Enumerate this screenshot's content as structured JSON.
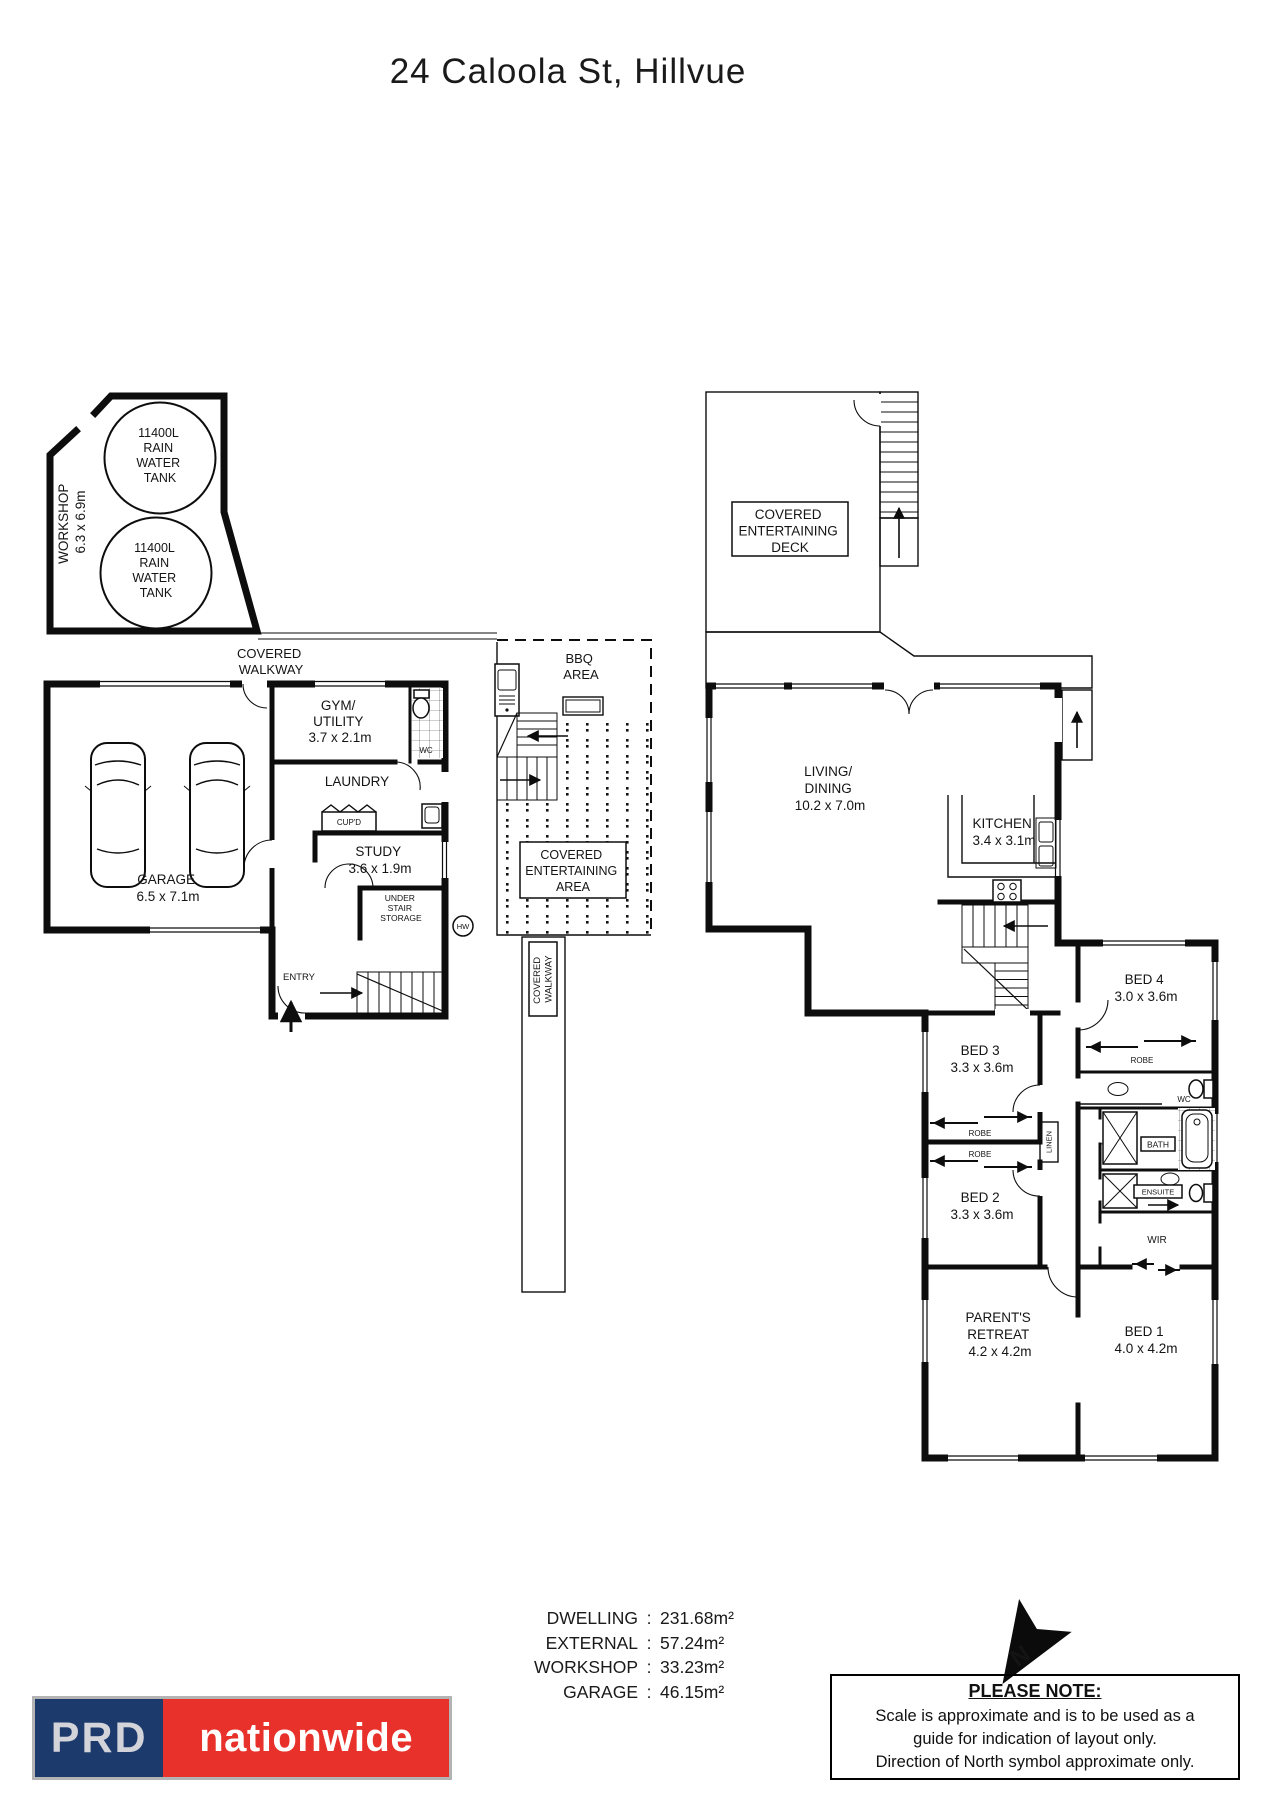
{
  "title": "24 Caloola St, Hillvue",
  "plan": {
    "workshop": {
      "name": "WORKSHOP",
      "dims": "6.3 x 6.9m"
    },
    "tank": {
      "l1": "11400L",
      "l2": "RAIN",
      "l3": "WATER",
      "l4": "TANK"
    },
    "covered_walkway": {
      "l1": "COVERED",
      "l2": "WALKWAY"
    },
    "garage": {
      "name": "GARAGE",
      "dims": "6.5 x 7.1m"
    },
    "gym": {
      "l1": "GYM/",
      "l2": "UTILITY",
      "dims": "3.7 x 2.1m"
    },
    "wc": "WC",
    "laundry": "LAUNDRY",
    "cupd": "CUP'D",
    "study": {
      "name": "STUDY",
      "dims": "3.6 x 1.9m"
    },
    "under_stair": {
      "l1": "UNDER",
      "l2": "STAIR",
      "l3": "STORAGE"
    },
    "entry": "ENTRY",
    "hw": "HW",
    "bbq": {
      "l1": "BBQ",
      "l2": "AREA"
    },
    "covered_entertaining_area": {
      "l1": "COVERED",
      "l2": "ENTERTAINING",
      "l3": "AREA"
    },
    "deck": {
      "l1": "COVERED",
      "l2": "ENTERTAINING",
      "l3": "DECK"
    },
    "living": {
      "l1": "LIVING/",
      "l2": "DINING",
      "dims": "10.2 x 7.0m"
    },
    "kitchen": {
      "name": "KITCHEN",
      "dims": "3.4 x 3.1m"
    },
    "bed1": {
      "name": "BED 1",
      "dims": "4.0 x 4.2m"
    },
    "bed2": {
      "name": "BED 2",
      "dims": "3.3 x 3.6m"
    },
    "bed3": {
      "name": "BED 3",
      "dims": "3.3 x 3.6m"
    },
    "bed4": {
      "name": "BED 4",
      "dims": "3.0 x 3.6m"
    },
    "parents": {
      "l1": "PARENT'S",
      "l2": "RETREAT",
      "dims": "4.2 x 4.2m"
    },
    "robe": "ROBE",
    "linen": "LINEN",
    "bath": "BATH",
    "ensuite": "ENSUITE",
    "wir": "WIR",
    "north": "N"
  },
  "areas": {
    "separator": ":",
    "rows": [
      {
        "label": "DWELLING",
        "value": "231.68m²"
      },
      {
        "label": "EXTERNAL",
        "value": "57.24m²"
      },
      {
        "label": "WORKSHOP",
        "value": "33.23m²"
      },
      {
        "label": "GARAGE",
        "value": "46.15m²"
      }
    ]
  },
  "logo": {
    "brand": "PRD",
    "sub": "nationwide",
    "navy": "#1d3a6d",
    "red": "#e8312a"
  },
  "note": {
    "heading": "PLEASE NOTE:",
    "line1": "Scale is approximate and is to be used as a",
    "line2": "guide for indication of layout only.",
    "line3": "Direction of North symbol approximate only."
  }
}
